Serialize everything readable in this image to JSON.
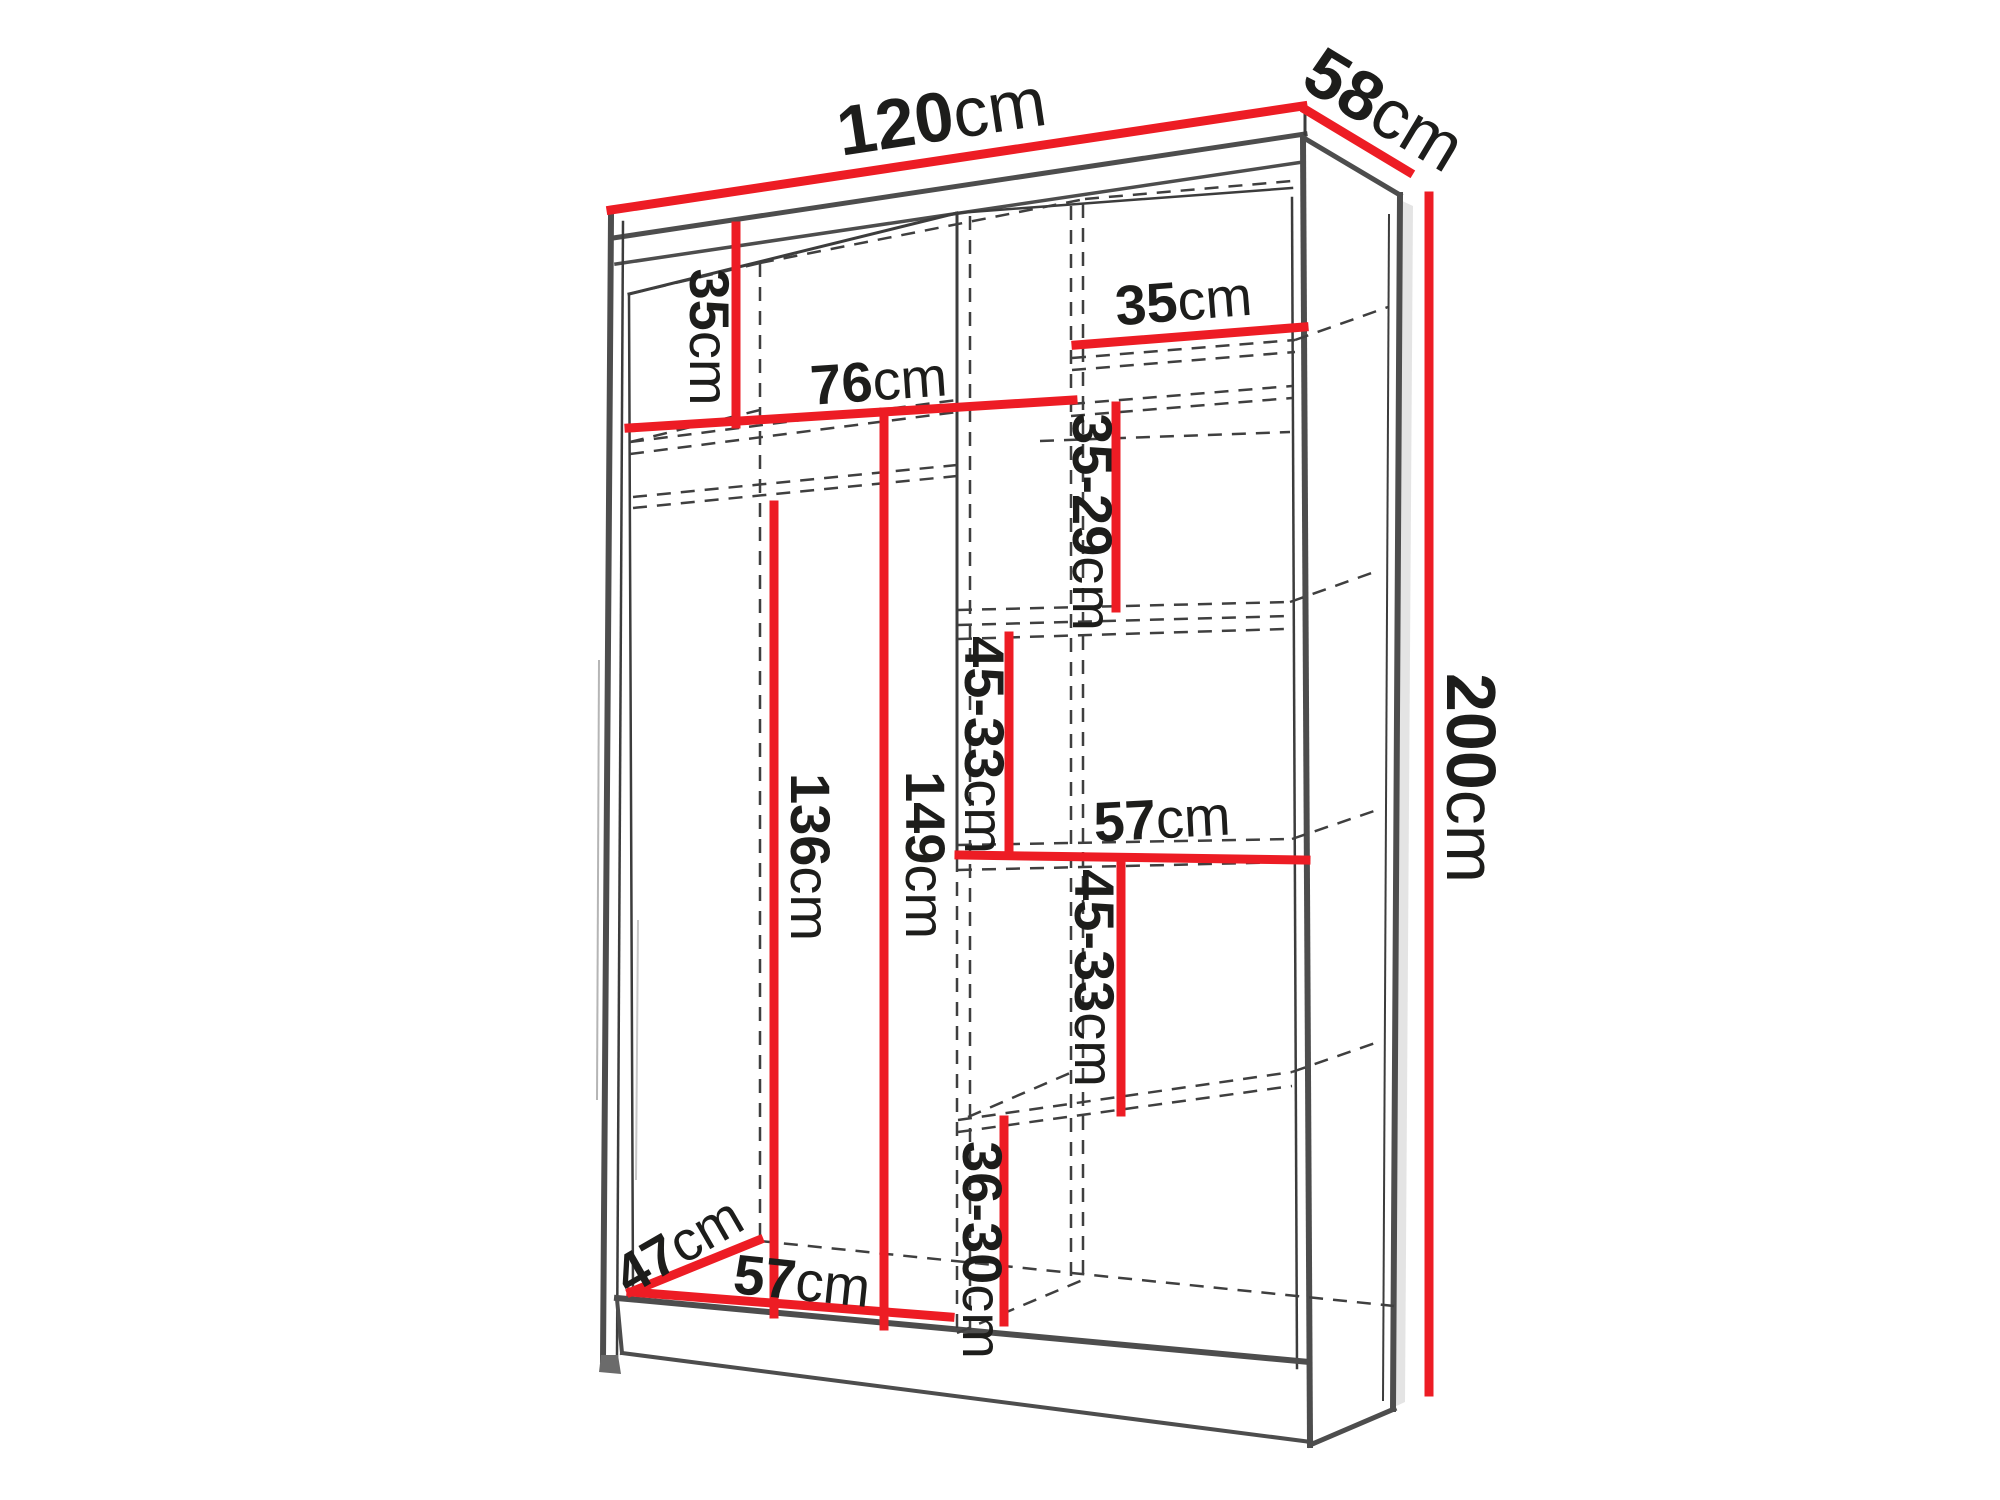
{
  "diagram": {
    "type": "furniture-dimension-diagram",
    "subject": "two-section sliding wardrobe interior dimensions",
    "unit": "cm",
    "colors": {
      "dimension_line": "#ed1c24",
      "outline": "#4d4d4d",
      "hidden_line": "#3f3f3f",
      "text": "#1d1d1b",
      "background": "#ffffff"
    },
    "dimensions": {
      "width_top": {
        "value": "120",
        "unit": "cm"
      },
      "depth_top": {
        "value": "58",
        "unit": "cm"
      },
      "height_right": {
        "value": "200",
        "unit": "cm"
      },
      "left_top_shelf_drop": {
        "value": "35",
        "unit": "cm"
      },
      "left_section_width": {
        "value": "76",
        "unit": "cm"
      },
      "right_top_shelf_width": {
        "value": "35",
        "unit": "cm"
      },
      "right_shelf_gap_1": {
        "value": "35-29",
        "unit": "cm"
      },
      "right_shelf_gap_2": {
        "value": "45-33",
        "unit": "cm"
      },
      "right_section_width": {
        "value": "57",
        "unit": "cm"
      },
      "right_shelf_gap_3": {
        "value": "45-33",
        "unit": "cm"
      },
      "right_shelf_gap_4": {
        "value": "36-30",
        "unit": "cm"
      },
      "hanging_space_height": {
        "value": "136",
        "unit": "cm"
      },
      "left_section_height": {
        "value": "149",
        "unit": "cm"
      },
      "interior_depth": {
        "value": "47",
        "unit": "cm"
      },
      "bottom_section_width": {
        "value": "57",
        "unit": "cm"
      }
    }
  }
}
